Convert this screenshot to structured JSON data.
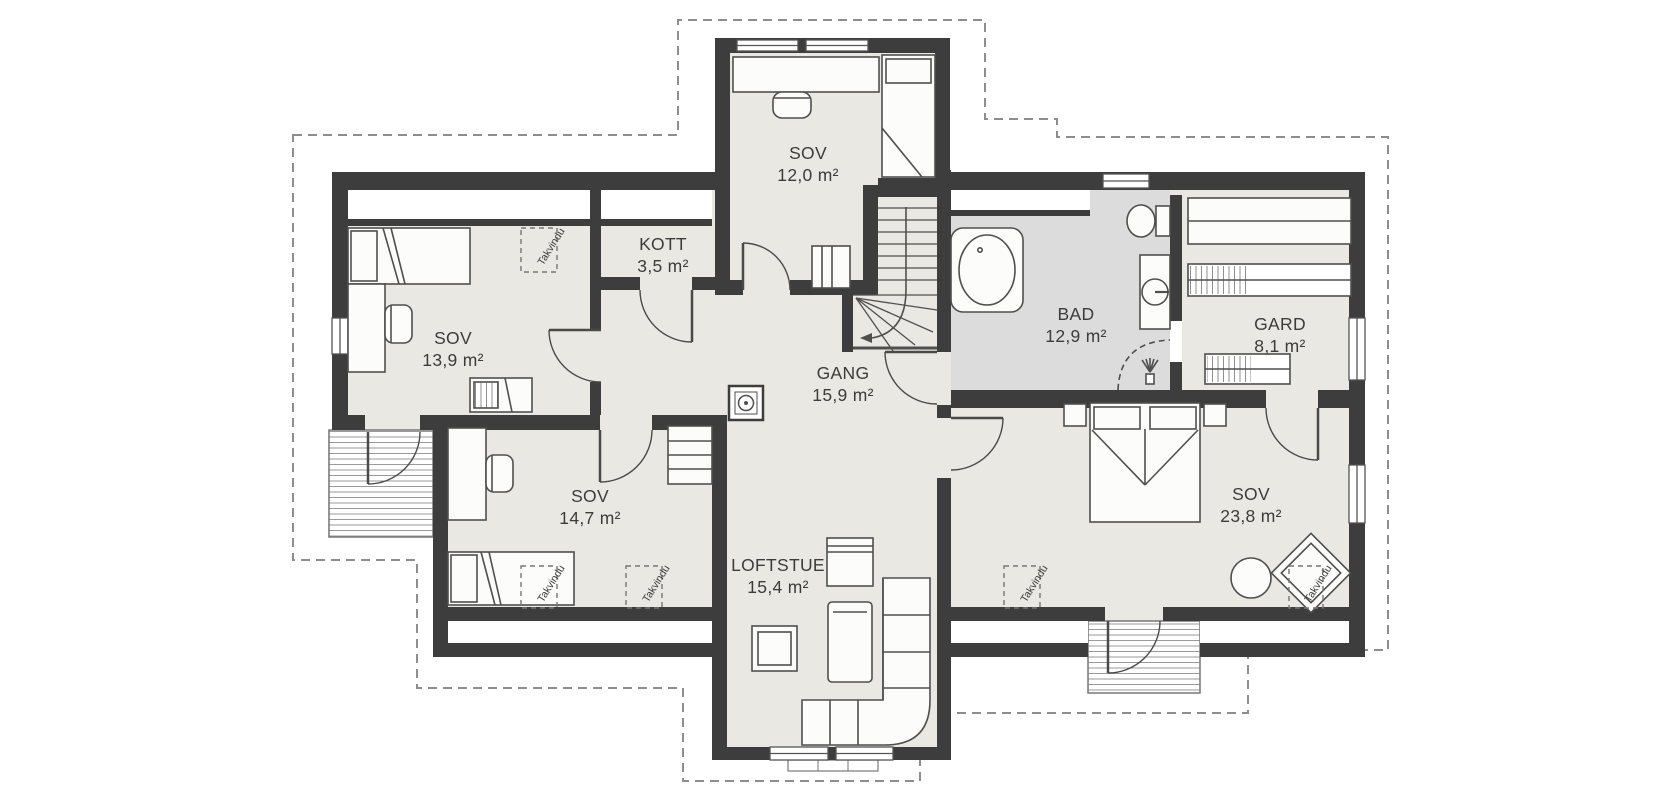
{
  "plan": {
    "type": "floorplan-loft",
    "colors": {
      "wall": "#3d3d3d",
      "floor": "#e9e8e2",
      "bath_floor": "#dcdcdd",
      "furniture_fill": "#fcfcfa",
      "furniture_stroke": "#4f4f4f",
      "roof_outline_dash": "#8e8e8e",
      "balcony_hatch": "#9a9a9a"
    },
    "labels": {
      "skylight": "Takvindu"
    },
    "rooms": [
      {
        "id": "sov-12",
        "name": "SOV",
        "area": "12,0 m²"
      },
      {
        "id": "kott",
        "name": "KOTT",
        "area": "3,5 m²"
      },
      {
        "id": "sov-139",
        "name": "SOV",
        "area": "13,9 m²"
      },
      {
        "id": "gang",
        "name": "GANG",
        "area": "15,9 m²"
      },
      {
        "id": "bad",
        "name": "BAD",
        "area": "12,9 m²"
      },
      {
        "id": "gard",
        "name": "GARD",
        "area": "8,1 m²"
      },
      {
        "id": "sov-147",
        "name": "SOV",
        "area": "14,7 m²"
      },
      {
        "id": "sov-238",
        "name": "SOV",
        "area": "23,8 m²"
      },
      {
        "id": "loftstue",
        "name": "LOFTSTUE",
        "area": "15,4 m²"
      }
    ]
  }
}
